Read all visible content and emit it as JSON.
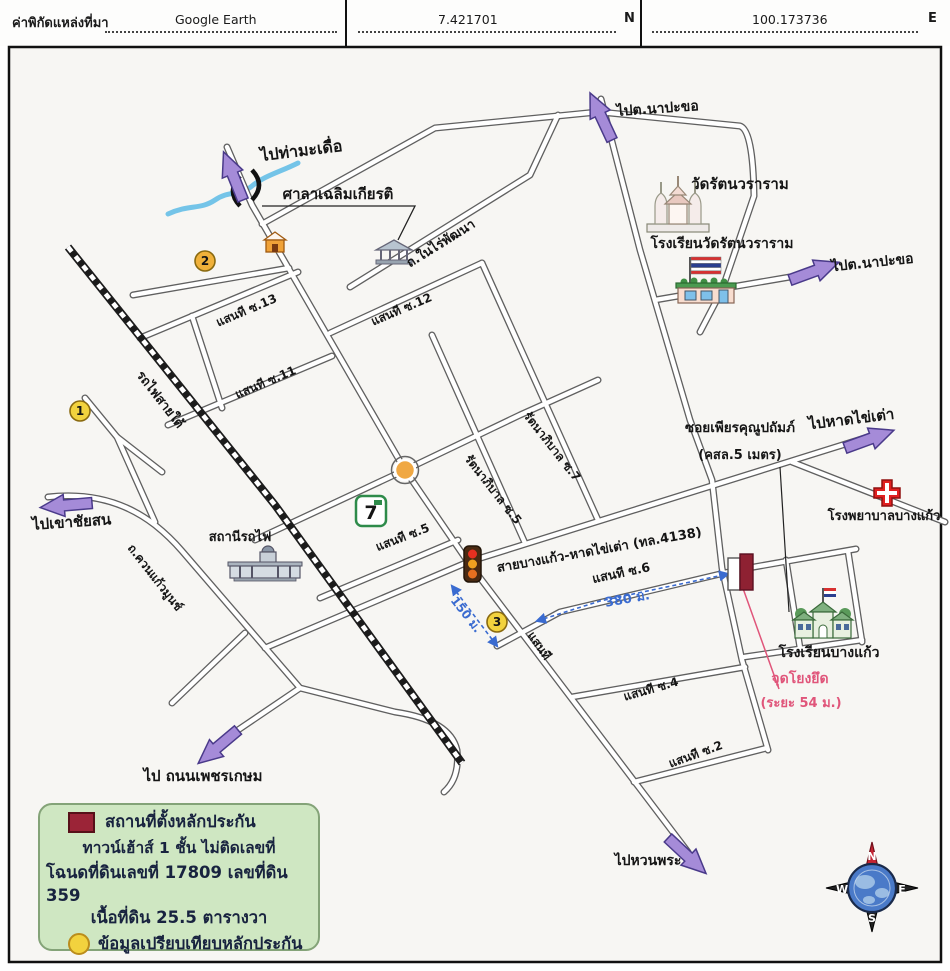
{
  "header": {
    "source_label": "ค่าพิกัดแหล่งที่มา",
    "source_value": "Google Earth",
    "latitude": "7.421701",
    "latitude_dir": "N",
    "longitude": "100.173736",
    "longitude_dir": "E"
  },
  "map": {
    "labels": {
      "to_tha_maduea": "ไปท่ามะเดื่อ",
      "sala_chalermkiat": "ศาลาเฉลิมเกียรติ",
      "nai_rai_rd": "ถ.ในไร่พัฒนา",
      "to_napakho_top": "ไปต.นาปะขอ",
      "wat_rattana": "วัดรัตนวราราม",
      "wat_school": "โรงเรียนวัดรัตนวราราม",
      "to_napakho_right": "ไปต.นาปะขอ",
      "soi13": "แสนที ซ.13",
      "soi12": "แสนที ซ.12",
      "soi11": "แสนที ซ.11",
      "railway_south": "รถไฟสายใต้",
      "to_khao_chaison": "ไปเขาชัยสน",
      "khuan_kaeo_rd": "ถ.ควนแก้วมูนช์",
      "railway_station": "สถานีรถไฟ",
      "soi5": "แสนที ซ.5",
      "rattana5": "รัตนาภิบาล ซ.5",
      "rattana7": "รัตนาภิบาล ซ.7",
      "highway_4138": "สายบางแก้ว-หาดไข่เต่า (ทล.4138)",
      "soi6": "แสนที ซ.6",
      "dist150": "150 ม.",
      "dist380": "380 ม.",
      "sansi_main": "แสนที",
      "phian_soi": "ซอยเพียรคุณูปถัมภ์",
      "phian_soi_size": "(คสล.5 เมตร)",
      "to_hat_khai_tao": "ไปหาดไข่เต่า",
      "hospital": "โรงพยาบาลบางแก้ว",
      "bangkaeo_school": "โรงเรียนบางแก้ว",
      "anchor_point": "จุดโยงยึด",
      "anchor_dist": "(ระยะ 54 ม.)",
      "soi4": "แสนที ซ.4",
      "soi2": "แสนที ซ.2",
      "to_huan_phra": "ไปหวนพระ",
      "to_phetkasem": "ไป ถนนเพชรเกษม"
    },
    "markers": {
      "n1": "1",
      "n2": "2",
      "n3": "3",
      "seven": "7"
    },
    "compass": {
      "n": "N",
      "e": "E",
      "s": "S",
      "w": "W"
    }
  },
  "legend": {
    "line1": "สถานที่ตั้งหลักประกัน",
    "line2": "ทาวน์เฮ้าส์ 1 ชั้น ไม่ติดเลขที่",
    "line3": "โฉนดที่ดินเลขที่ 17809 เลขที่ดิน 359",
    "line4": "เนื้อที่ดิน 25.5 ตารางวา",
    "line5": "ข้อมูลเปรียบเทียบหลักประกัน"
  },
  "colors": {
    "arrow_purple": "#a58bd8",
    "measure_blue": "#3a6bd0",
    "anchor_pink": "#e0557a",
    "legend_green": "#cfe7c2",
    "collateral_maroon": "#9b2437",
    "marker_yellow": "#f2d23e"
  }
}
